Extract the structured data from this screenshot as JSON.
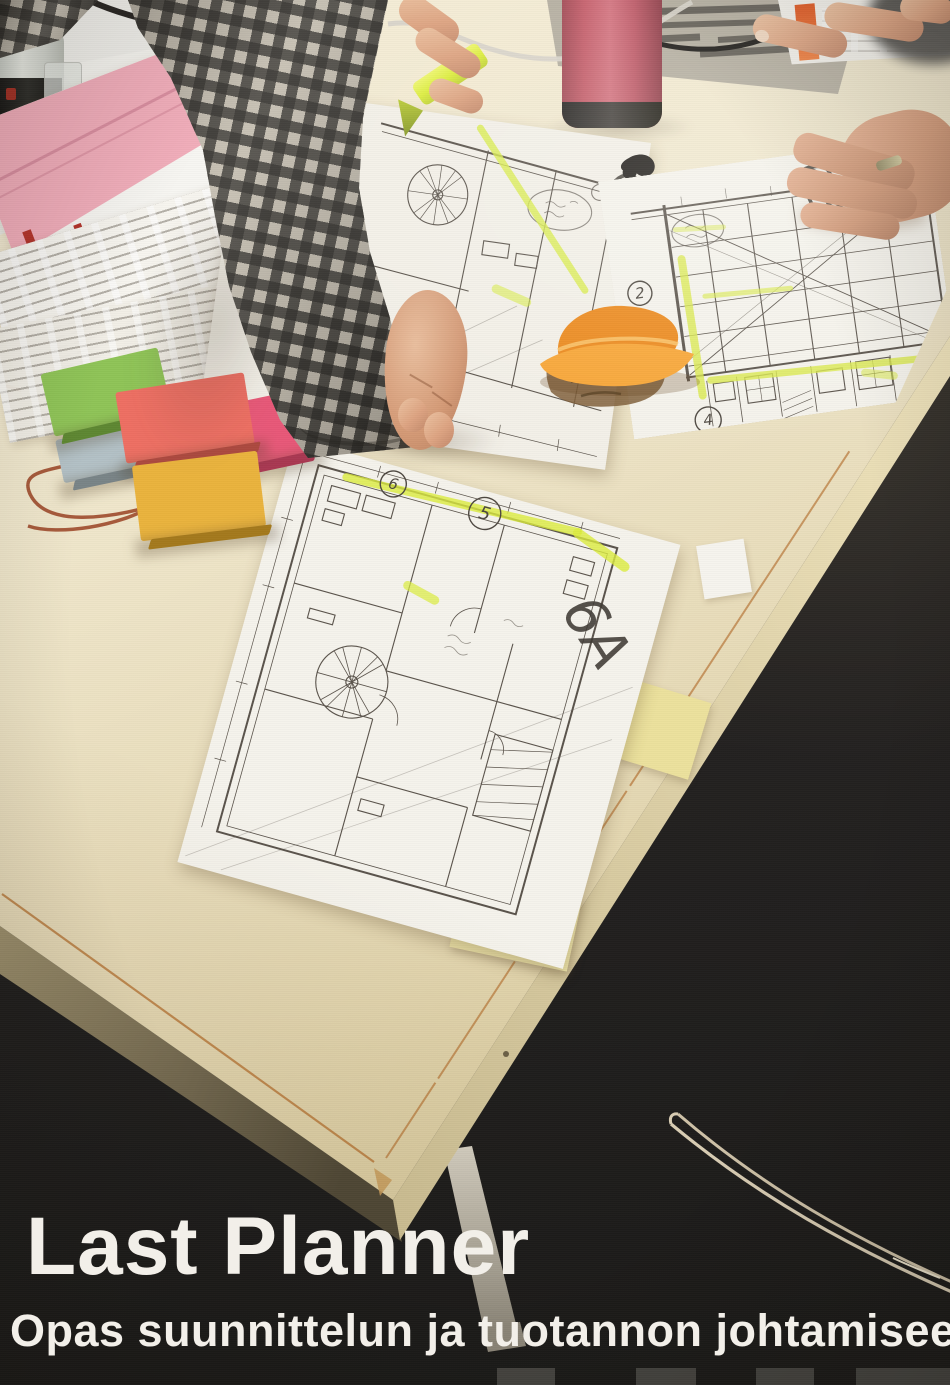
{
  "cover": {
    "title": "Last Planner",
    "subtitle": "Opas suunnittelun ja tuotannon johtamiseen"
  },
  "drawings": {
    "sheet_a_label": "6A",
    "sheet_b_label": "6B",
    "sheet_mid_label": "6",
    "circled": {
      "two": "2",
      "four": "4",
      "five": "5",
      "six": "6"
    }
  },
  "papers": {
    "gray_schedule_header": "010"
  },
  "colors": {
    "floor": "#262320",
    "tabletop": "#eee5c9",
    "table_seam": "#b46f2e",
    "thermos": "#c9626f",
    "highlighter": "#dced3f",
    "sticky_green": "#8fc457",
    "sticky_salmon": "#ee6f63",
    "sticky_magenta": "#e85878",
    "sticky_yellow": "#eab33d",
    "sticky_orange": "#f49a2e",
    "sticky_blue": "#b3c1c6",
    "gantt_pink": "#f2aebb",
    "bar_red": "#b5342c",
    "bar_blue": "#4f6fae",
    "bar_navy": "#27418a",
    "bar_green": "#7fae4e",
    "title_text": "#f2efe9",
    "shirt_check": "#3a3833",
    "skin": "#dda482"
  }
}
